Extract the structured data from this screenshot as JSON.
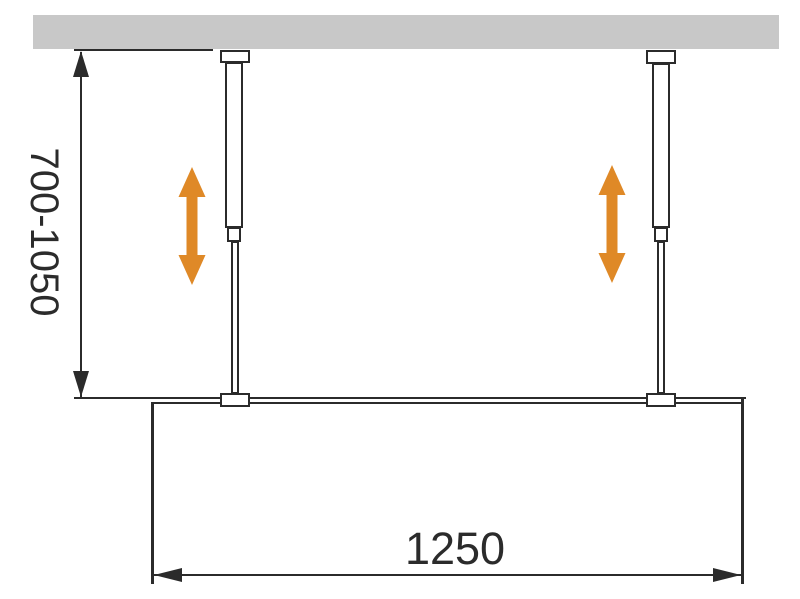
{
  "diagram": {
    "height_dimension": {
      "label": "700-1050"
    },
    "width_dimension": {
      "label": "1250"
    }
  },
  "colors": {
    "background": "#FFFFFF",
    "ceiling": "#C8C8C8",
    "line": "#2B2B2B",
    "text": "#2B2B2B",
    "accent": "#DF8927"
  },
  "icons": {
    "height_adjust_arrow": "double-headed-vertical-arrow",
    "dimension_arrowhead": "slender-triangle"
  }
}
